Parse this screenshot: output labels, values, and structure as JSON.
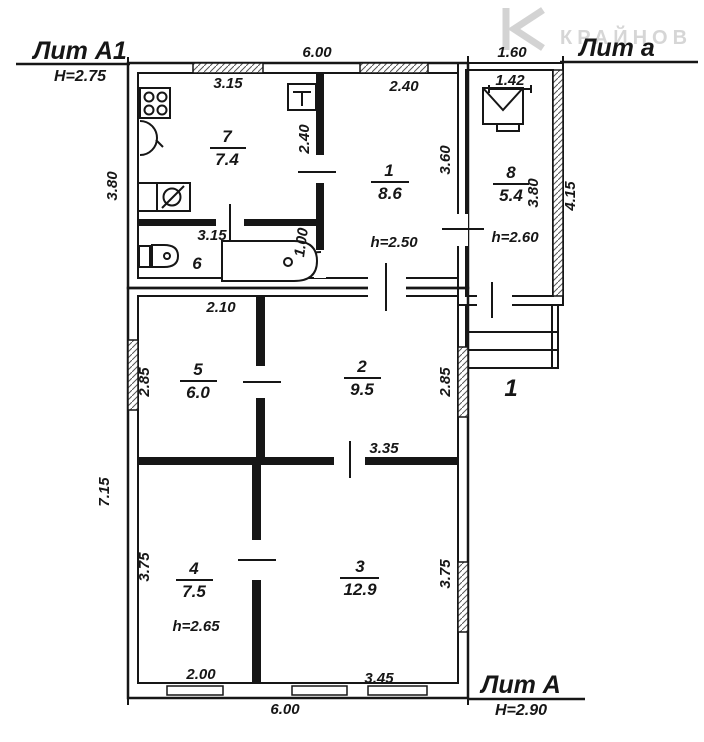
{
  "document": {
    "type": "floor-plan",
    "style": "BTI scanned technical plan"
  },
  "colors": {
    "line": "#161616",
    "paper": "#ffffff",
    "watermark": "#cccccc"
  },
  "blocks": {
    "lit_a1": {
      "label": "Лит А1",
      "height_note": "Н=2.75"
    },
    "lit_a_annex": {
      "label": "Лит а"
    },
    "lit_a_main": {
      "label": "Лит А",
      "height_note": "Н=2.90"
    }
  },
  "watermark": {
    "logo": "K-chevron-logo",
    "text": "КРАЙНОВ"
  },
  "rooms": [
    {
      "num": "7",
      "area": "7.4"
    },
    {
      "num": "1",
      "area": "8.6",
      "ceiling": "h=2.50"
    },
    {
      "num": "8",
      "area": "5.4",
      "ceiling": "h=2.60"
    },
    {
      "num": "6"
    },
    {
      "num": "5",
      "area": "6.0"
    },
    {
      "num": "2",
      "area": "9.5"
    },
    {
      "num": "4",
      "area": "7.5",
      "ceiling": "h=2.65"
    },
    {
      "num": "3",
      "area": "12.9"
    },
    {
      "num": "1"
    }
  ],
  "dims": {
    "top_total": "6.00",
    "annex_top": "1.60",
    "room7_top": "3.15",
    "room1_top": "2.40",
    "room8_top": "1.42",
    "room7_right": "2.40",
    "room1_right": "3.60",
    "left_upper": "3.80",
    "room8_inner": "3.80",
    "annex_right": "4.15",
    "room6_width": "3.15",
    "bath_width": "1.00",
    "room5_top": "2.10",
    "room5_left": "2.85",
    "room2_right": "2.85",
    "room3_top": "3.35",
    "left_lower": "7.15",
    "room4_left": "3.75",
    "room3_right": "3.75",
    "room4_bottom": "2.00",
    "room3_bottom": "3.45",
    "bottom_total": "6.00"
  },
  "icons": {
    "stove": "stove-4-burners-icon",
    "basin": "wash-basin-icon",
    "sink": "kitchen-sink-icon",
    "toilet": "toilet-icon",
    "bathtub": "bathtub-icon",
    "heater": "water-heater-icon",
    "boiler": "boiler-envelope-icon"
  }
}
